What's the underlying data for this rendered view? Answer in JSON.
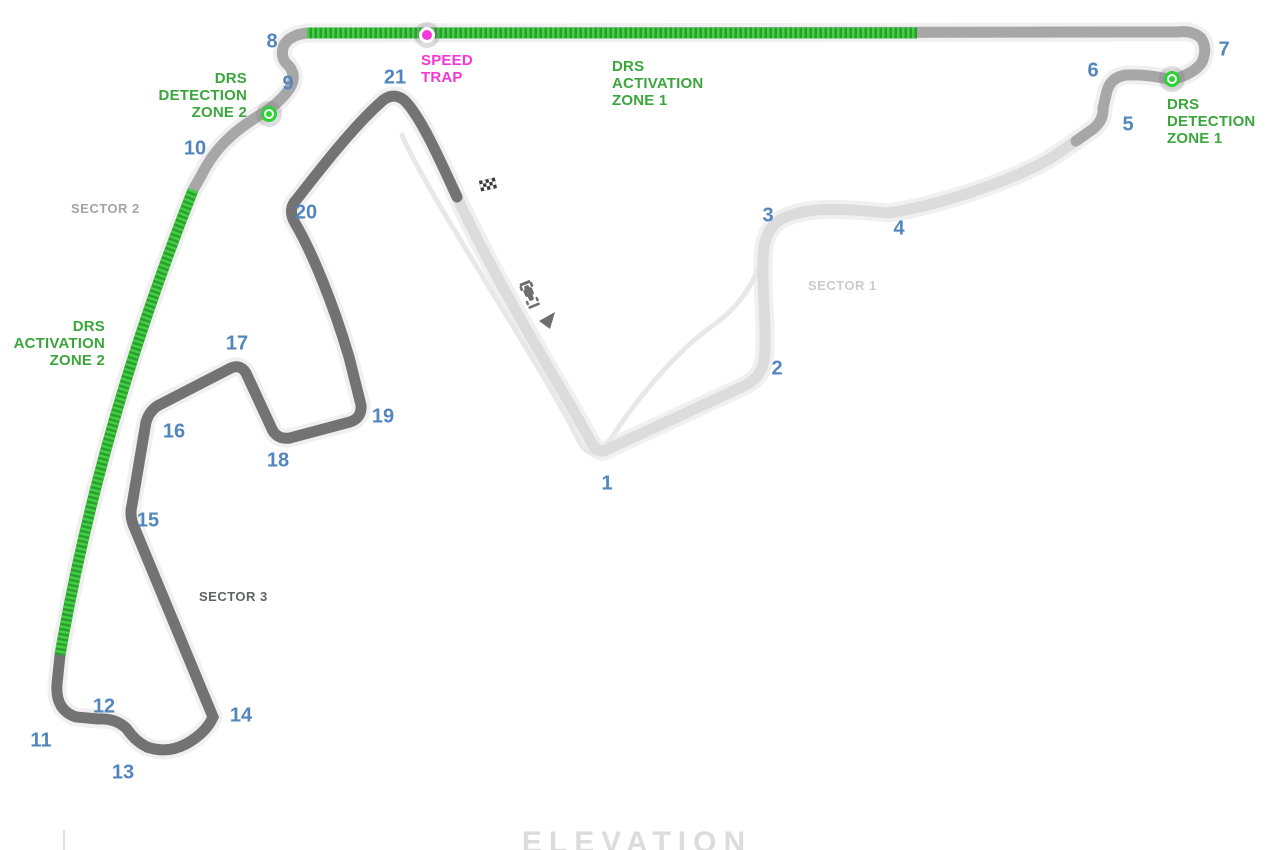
{
  "labels": {
    "speed_trap": "SPEED\nTRAP",
    "drs_activation_zone_1": "DRS\nACTIVATION\nZONE 1",
    "drs_activation_zone_2": "DRS\nACTIVATION\nZONE 2",
    "drs_detection_zone_1": "DRS\nDETECTION\nZONE 1",
    "drs_detection_zone_2": "DRS\nDETECTION\nZONE 2",
    "sector_1": "SECTOR 1",
    "sector_2": "SECTOR 2",
    "sector_3": "SECTOR 3",
    "elevation": "ELEVATION"
  },
  "turns": [
    "1",
    "2",
    "3",
    "4",
    "5",
    "6",
    "7",
    "8",
    "9",
    "10",
    "11",
    "12",
    "13",
    "14",
    "15",
    "16",
    "17",
    "18",
    "19",
    "20",
    "21"
  ],
  "icons": {
    "checkered_flag": "start-finish line",
    "race_car": "race direction car",
    "direction_arrow": "race direction arrow",
    "speed_trap_dot": "speed trap location",
    "drs_detection_dot_1": "DRS detection point 1",
    "drs_detection_dot_2": "DRS detection point 2"
  },
  "colors": {
    "track_casing": "#f0f0f0",
    "track_sector1": "#dcdcdc",
    "track_sector2": "#a7a7a7",
    "track_sector3": "#737373",
    "pit_lane": "#e8e8e8",
    "drs_green_dark": "#2e9c33",
    "drs_green_bright": "#3fd13f",
    "detection_dot_green": "#2bd135",
    "green_text": "#3ba63c",
    "magenta": "#f437d6",
    "turn_number_blue": "#5386bc",
    "sector1_label": "#cccccc",
    "sector2_label": "#a5a5a5",
    "sector3_label": "#606468",
    "elevation_text": "#dcdcdc",
    "axis_tick": "#e0e0e0",
    "car_gray": "#6e6e6e",
    "halo_gray": "rgba(120,120,120,0.25)"
  }
}
